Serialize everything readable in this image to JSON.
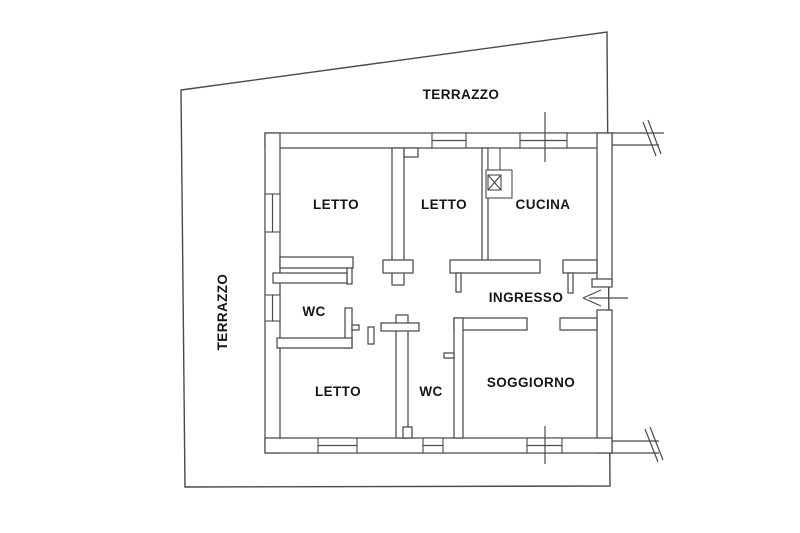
{
  "figure": {
    "kind": "architectural floor plan",
    "language": "Italian"
  },
  "labels": {
    "terrace_top": "TERRAZZO",
    "terrace_left": "TERRAZZO",
    "bedroom_nw": "LETTO",
    "bedroom_n": "LETTO",
    "kitchen": "CUCINA",
    "bathroom_mid": "WC",
    "entrance_hall": "INGRESSO",
    "bedroom_sw": "LETTO",
    "bathroom_s": "WC",
    "living_room": "SOGGIORNO"
  },
  "icons": {
    "entrance_arrow": "left-arrow",
    "flue_box": "crossed-square"
  },
  "colors": {
    "background": "#ffffff",
    "line": "#4a4a4a",
    "text": "#161616"
  }
}
